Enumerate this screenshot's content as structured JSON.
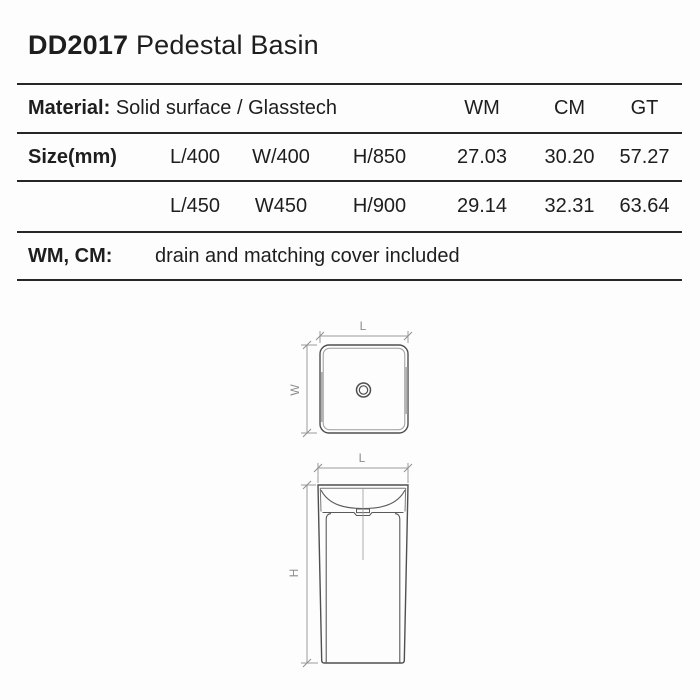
{
  "title": {
    "model": "DD2017",
    "name": "Pedestal Basin"
  },
  "spec_table": {
    "material_label": "Material:",
    "material_value": "Solid surface / Glasstech",
    "columns": [
      "WM",
      "CM",
      "GT"
    ],
    "size_label": "Size(mm)",
    "sizes": [
      {
        "l": "L/400",
        "w": "W/400",
        "h": "H/850",
        "wm": "27.03",
        "cm": "30.20",
        "gt": "57.27"
      },
      {
        "l": "L/450",
        "w": "W450",
        "h": "H/900",
        "wm": "29.14",
        "cm": "32.31",
        "gt": "63.64"
      }
    ],
    "note_label": "WM, CM:",
    "note_text": "drain and matching cover included"
  },
  "drawings": {
    "top_view": {
      "length_label": "L",
      "width_label": "W"
    },
    "front_view": {
      "length_label": "L",
      "height_label": "H"
    }
  },
  "colors": {
    "background": "#fdfdfd",
    "text": "#1e1e1e",
    "table_rule": "#262626",
    "drawing_outline": "#4f4f4f",
    "drawing_secondary": "#787878",
    "dimension_line": "#9a9a9a",
    "dimension_label": "#8c8c8c"
  }
}
